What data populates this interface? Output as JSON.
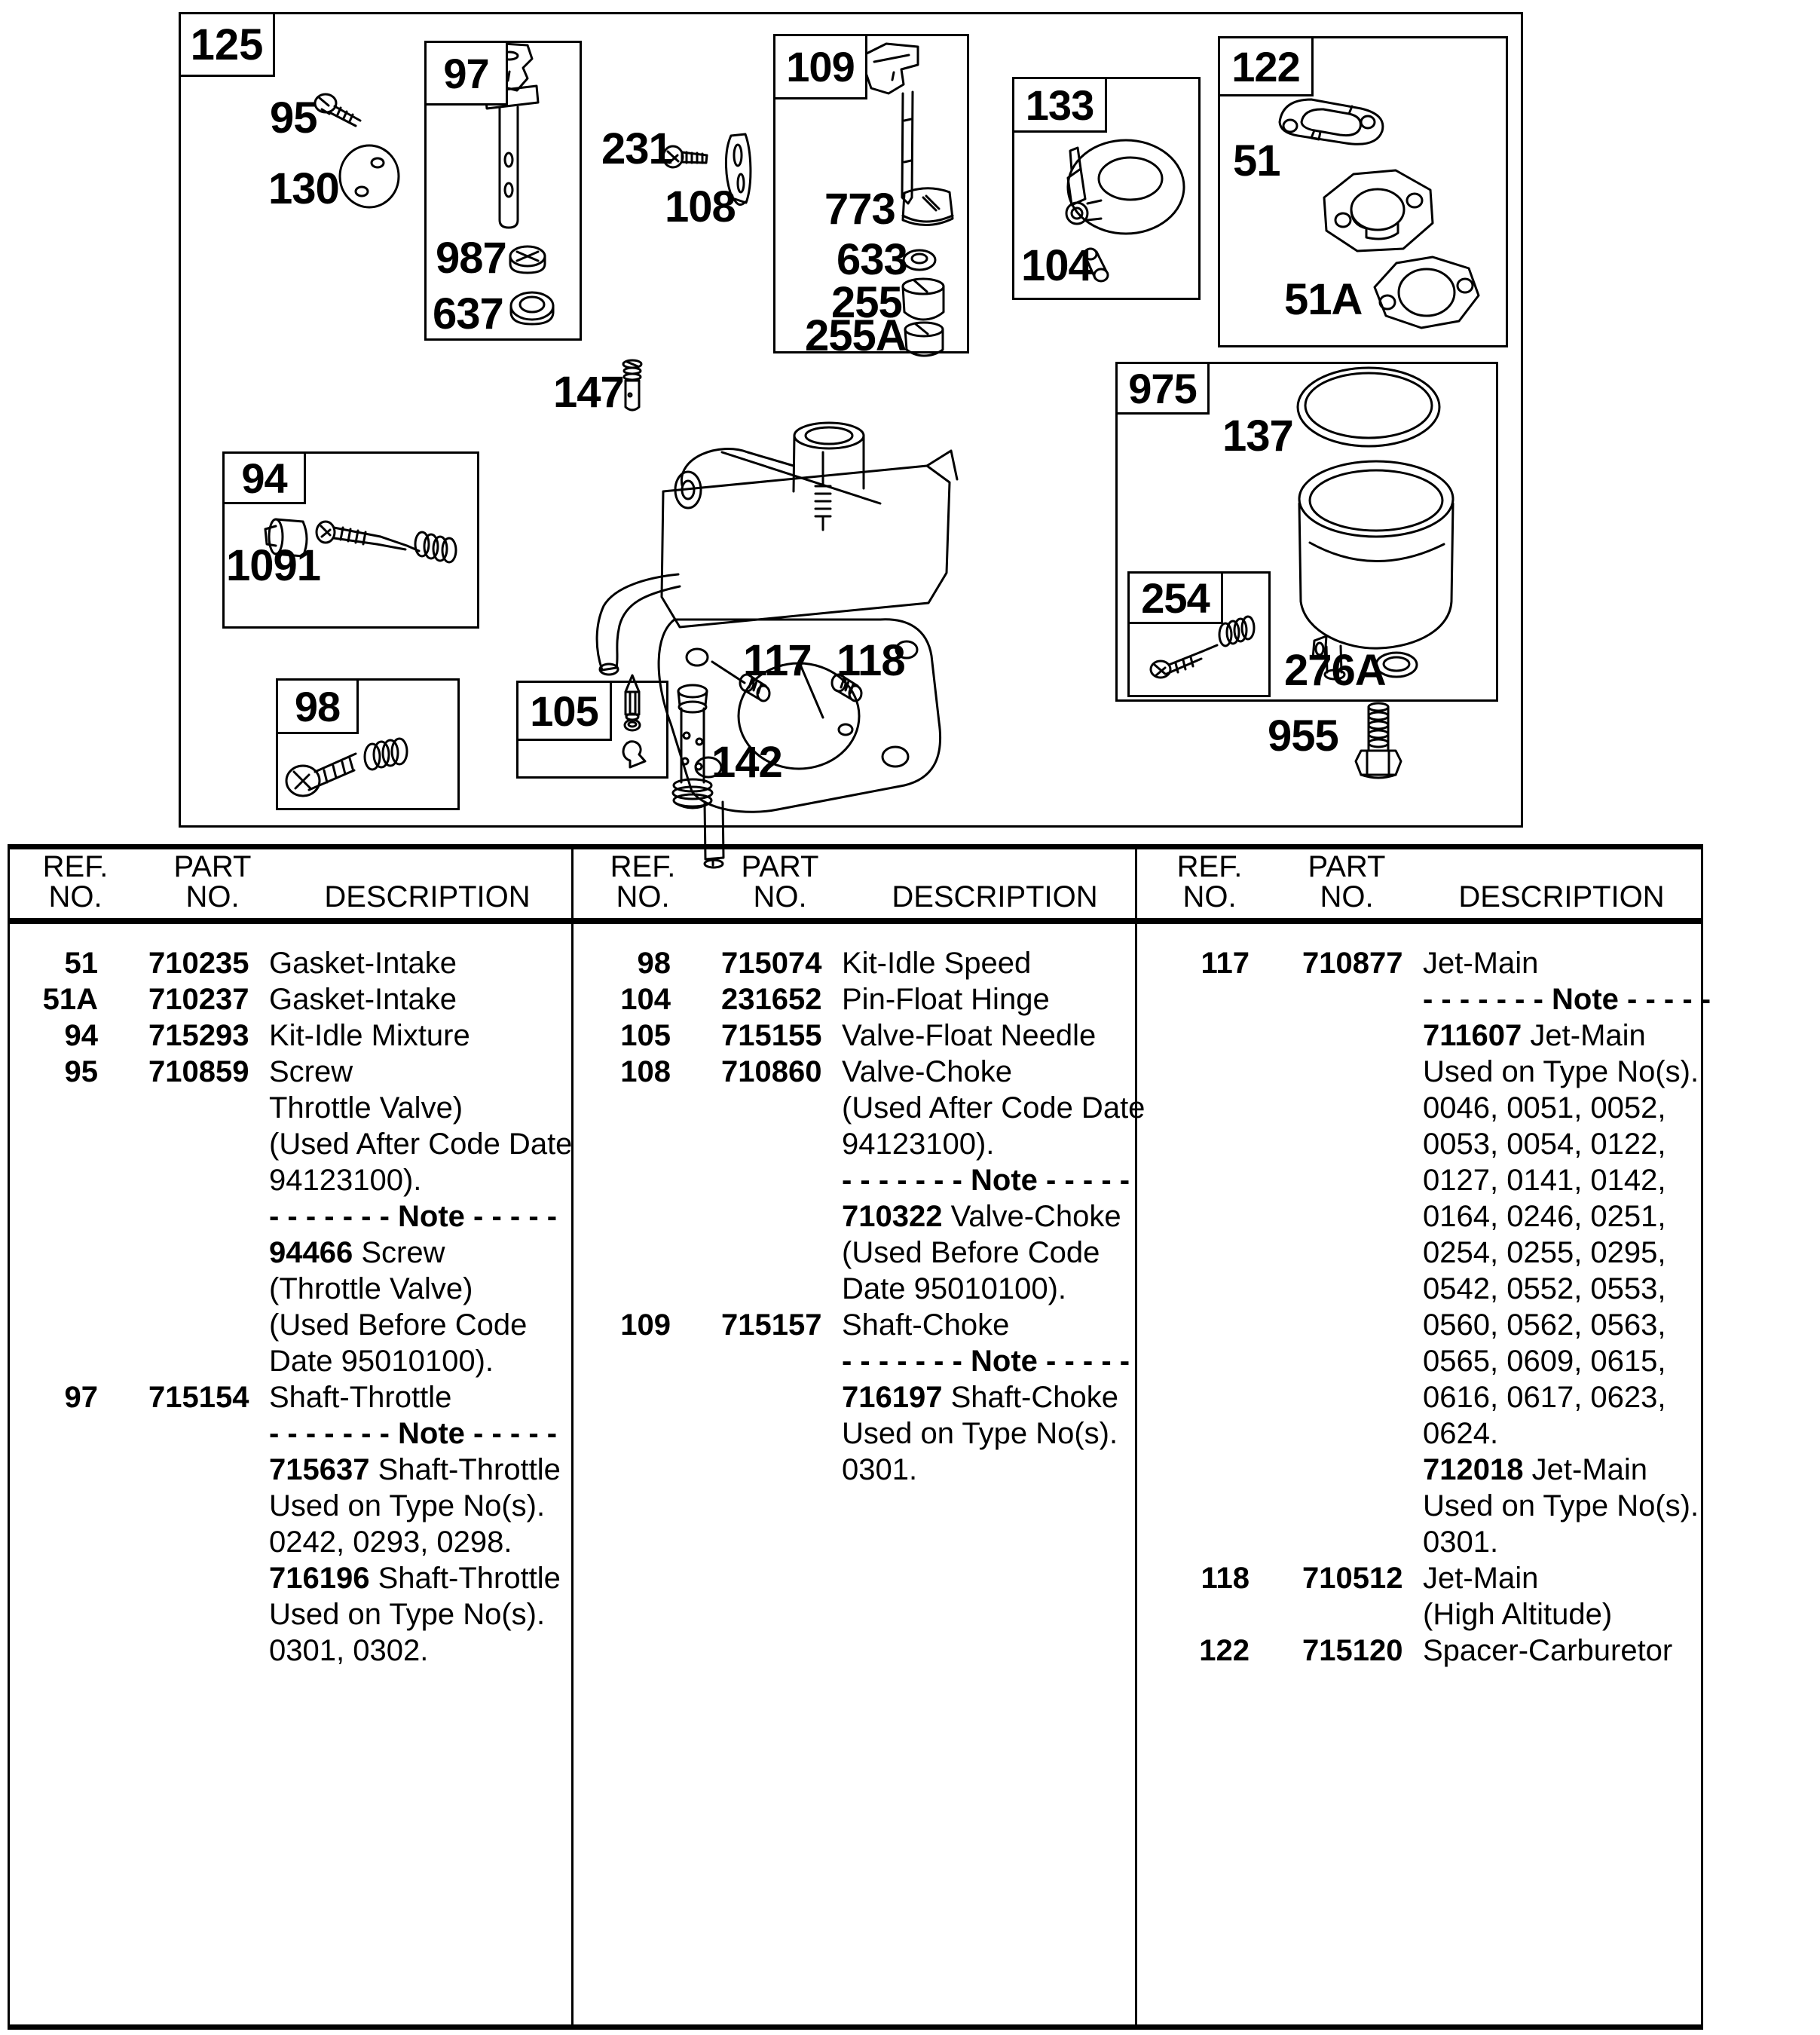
{
  "diagram": {
    "boxes": {
      "b125": "125",
      "b97": "97",
      "b109": "109",
      "b133": "133",
      "b122": "122",
      "b975": "975",
      "b94": "94",
      "b98": "98",
      "b105": "105",
      "b254": "254"
    },
    "callouts": {
      "c95": "95",
      "c130": "130",
      "c231": "231",
      "c108": "108",
      "c987": "987",
      "c637": "637",
      "c773": "773",
      "c633": "633",
      "c255": "255",
      "c255A": "255A",
      "c104": "104",
      "c51": "51",
      "c51A": "51A",
      "c147": "147",
      "c1091": "1091",
      "c117": "117",
      "c118": "118",
      "c142": "142",
      "c137": "137",
      "c276A": "276A",
      "c955": "955"
    }
  },
  "table": {
    "headers": {
      "ref1": "REF.",
      "ref2": "NO.",
      "part1": "PART",
      "part2": "NO.",
      "desc": "DESCRIPTION"
    },
    "columns": [
      [
        {
          "ref": "51",
          "part": "710235",
          "d": [
            {
              "t": "Gasket-Intake"
            }
          ]
        },
        {
          "ref": "51A",
          "part": "710237",
          "d": [
            {
              "t": "Gasket-Intake"
            }
          ]
        },
        {
          "ref": "94",
          "part": "715293",
          "d": [
            {
              "t": "Kit-Idle Mixture"
            }
          ]
        },
        {
          "ref": "95",
          "part": "710859",
          "d": [
            {
              "t": "Screw"
            }
          ]
        },
        {
          "d": [
            {
              "t": "Throttle Valve)"
            }
          ]
        },
        {
          "d": [
            {
              "t": "(Used After Code Date"
            }
          ]
        },
        {
          "d": [
            {
              "t": "94123100)."
            }
          ]
        },
        {
          "d": [
            {
              "b": "- - - - - - - Note - - - - -"
            }
          ]
        },
        {
          "d": [
            {
              "b": "94466"
            },
            {
              "t": " Screw"
            }
          ]
        },
        {
          "d": [
            {
              "t": "(Throttle Valve)"
            }
          ]
        },
        {
          "d": [
            {
              "t": "(Used Before Code"
            }
          ]
        },
        {
          "d": [
            {
              "t": "Date 95010100)."
            }
          ]
        },
        {
          "ref": "97",
          "part": "715154",
          "d": [
            {
              "t": "Shaft-Throttle"
            }
          ]
        },
        {
          "d": [
            {
              "b": "- - - - - - - Note - - - - -"
            }
          ]
        },
        {
          "d": [
            {
              "b": "715637"
            },
            {
              "t": " Shaft-Throttle"
            }
          ]
        },
        {
          "d": [
            {
              "t": "Used on Type No(s)."
            }
          ]
        },
        {
          "d": [
            {
              "t": "0242, 0293, 0298."
            }
          ]
        },
        {
          "d": [
            {
              "b": "716196"
            },
            {
              "t": " Shaft-Throttle"
            }
          ]
        },
        {
          "d": [
            {
              "t": "Used on Type No(s)."
            }
          ]
        },
        {
          "d": [
            {
              "t": "0301, 0302."
            }
          ]
        }
      ],
      [
        {
          "ref": "98",
          "part": "715074",
          "d": [
            {
              "t": "Kit-Idle Speed"
            }
          ]
        },
        {
          "ref": "104",
          "part": "231652",
          "d": [
            {
              "t": "Pin-Float Hinge"
            }
          ]
        },
        {
          "ref": "105",
          "part": "715155",
          "d": [
            {
              "t": "Valve-Float Needle"
            }
          ]
        },
        {
          "ref": "108",
          "part": "710860",
          "d": [
            {
              "t": "Valve-Choke"
            }
          ]
        },
        {
          "d": [
            {
              "t": "(Used After Code Date"
            }
          ]
        },
        {
          "d": [
            {
              "t": "94123100)."
            }
          ]
        },
        {
          "d": [
            {
              "b": "- - - - - - - Note - - - - -"
            }
          ]
        },
        {
          "d": [
            {
              "b": "710322"
            },
            {
              "t": " Valve-Choke"
            }
          ]
        },
        {
          "d": [
            {
              "t": "(Used Before Code"
            }
          ]
        },
        {
          "d": [
            {
              "t": "Date 95010100)."
            }
          ]
        },
        {
          "ref": "109",
          "part": "715157",
          "d": [
            {
              "t": "Shaft-Choke"
            }
          ]
        },
        {
          "d": [
            {
              "b": "- - - - - - - Note - - - - -"
            }
          ]
        },
        {
          "d": [
            {
              "b": "716197"
            },
            {
              "t": " Shaft-Choke"
            }
          ]
        },
        {
          "d": [
            {
              "t": "Used on Type No(s)."
            }
          ]
        },
        {
          "d": [
            {
              "t": "0301."
            }
          ]
        }
      ],
      [
        {
          "ref": "117",
          "part": "710877",
          "d": [
            {
              "t": "Jet-Main"
            }
          ]
        },
        {
          "d": [
            {
              "b": "- - - - - - - Note - - - - -"
            }
          ]
        },
        {
          "d": [
            {
              "b": "711607"
            },
            {
              "t": " Jet-Main"
            }
          ]
        },
        {
          "d": [
            {
              "t": "Used on Type No(s)."
            }
          ]
        },
        {
          "d": [
            {
              "t": "0046, 0051, 0052,"
            }
          ]
        },
        {
          "d": [
            {
              "t": "0053, 0054, 0122,"
            }
          ]
        },
        {
          "d": [
            {
              "t": "0127, 0141, 0142,"
            }
          ]
        },
        {
          "d": [
            {
              "t": "0164, 0246, 0251,"
            }
          ]
        },
        {
          "d": [
            {
              "t": "0254, 0255, 0295,"
            }
          ]
        },
        {
          "d": [
            {
              "t": "0542, 0552, 0553,"
            }
          ]
        },
        {
          "d": [
            {
              "t": "0560, 0562, 0563,"
            }
          ]
        },
        {
          "d": [
            {
              "t": "0565, 0609, 0615,"
            }
          ]
        },
        {
          "d": [
            {
              "t": "0616, 0617, 0623,"
            }
          ]
        },
        {
          "d": [
            {
              "t": "0624."
            }
          ]
        },
        {
          "d": [
            {
              "b": "712018"
            },
            {
              "t": " Jet-Main"
            }
          ]
        },
        {
          "d": [
            {
              "t": "Used on Type No(s)."
            }
          ]
        },
        {
          "d": [
            {
              "t": "0301."
            }
          ]
        },
        {
          "ref": "118",
          "part": "710512",
          "d": [
            {
              "t": "Jet-Main"
            }
          ]
        },
        {
          "d": [
            {
              "t": "(High Altitude)"
            }
          ]
        },
        {
          "ref": "122",
          "part": "715120",
          "d": [
            {
              "t": "Spacer-Carburetor"
            }
          ]
        }
      ]
    ]
  }
}
